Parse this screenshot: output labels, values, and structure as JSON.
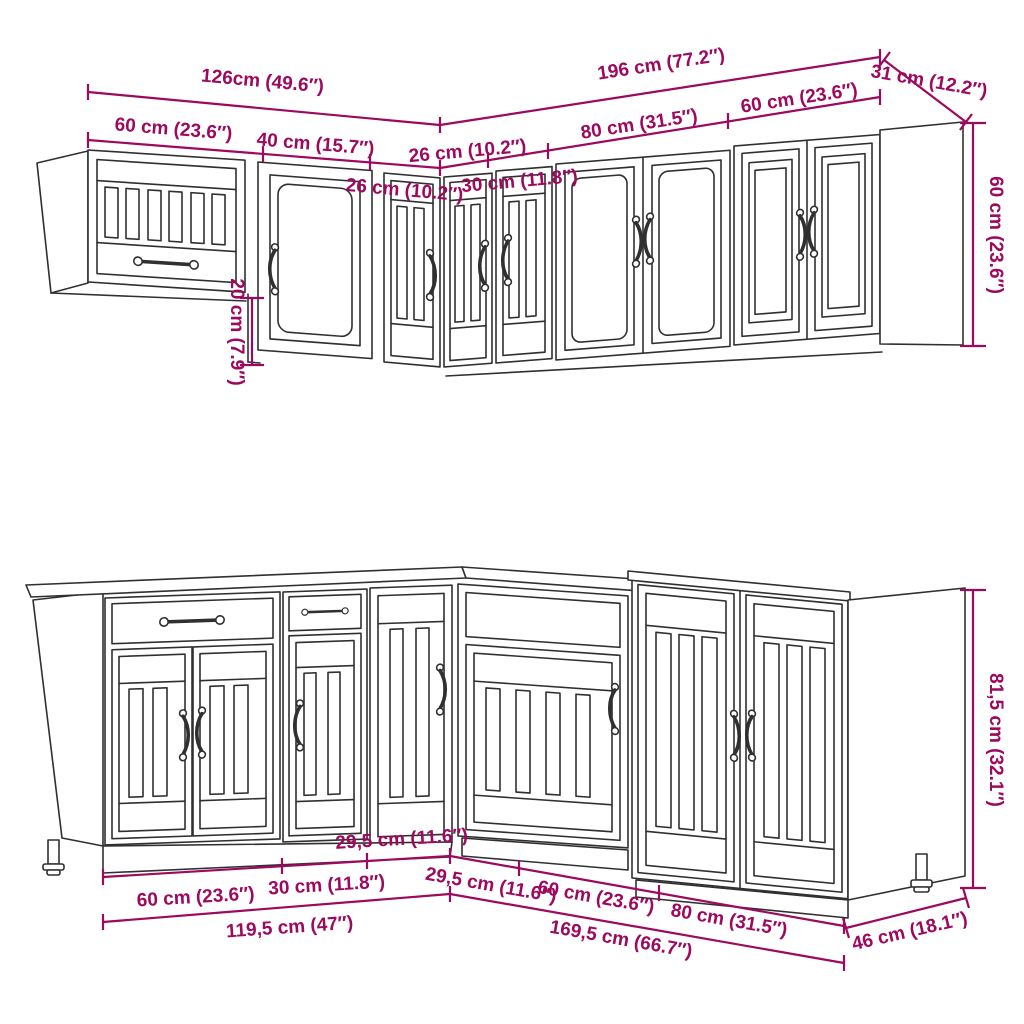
{
  "diagram": {
    "type": "kitchen-cabinet-set-dimension-drawing",
    "colors": {
      "dimension": "#9c095e",
      "line_art": "#303030",
      "background": "#ffffff"
    },
    "upper": {
      "total_left": "126cm (49.6″)",
      "total_right": "196 cm (77.2″)",
      "depth_right": "31 cm (12.2″)",
      "width_60_left": "60 cm (23.6″)",
      "width_40": "40 cm (15.7″)",
      "width_26_left": "26 cm (10.2″)",
      "width_26_right": "26 cm (10.2″)",
      "width_30": "30 cm (11.8″)",
      "width_80": "80 cm (31.5″)",
      "width_60_right": "60 cm (23.6″)",
      "height_right": "60 cm (23.6″)",
      "step_height": "20 cm (7.9″)"
    },
    "base": {
      "width_60_left": "60 cm (23.6″)",
      "width_30": "30 cm (11.8″)",
      "width_29_5_left": "29,5 cm (11.6″)",
      "width_29_5_right": "29,5 cm (11.6″)",
      "width_60_right": "60 cm (23.6″)",
      "width_80": "80 cm (31.5″)",
      "total_left": "119,5 cm (47″)",
      "total_right": "169,5 cm (66.7″)",
      "depth_right": "46 cm (18.1″)",
      "height_right": "81,5 cm (32.1″)"
    }
  }
}
